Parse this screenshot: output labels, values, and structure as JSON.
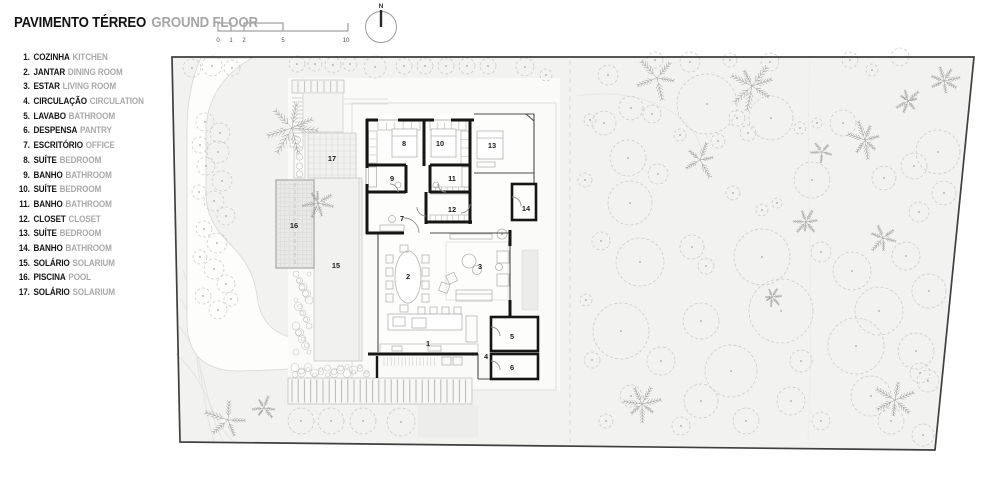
{
  "header": {
    "title_pt": "PAVIMENTO TÉRREO",
    "title_en": "GROUND FLOOR"
  },
  "scalebar": {
    "ticks": [
      "0",
      "1",
      "2",
      "5",
      "10"
    ]
  },
  "north": {
    "label": "N"
  },
  "legend": {
    "items": [
      {
        "num": "1.",
        "pt": "COZINHA",
        "en": "KITCHEN"
      },
      {
        "num": "2.",
        "pt": "JANTAR",
        "en": "DINING ROOM"
      },
      {
        "num": "3.",
        "pt": "ESTAR",
        "en": "LIVING ROOM"
      },
      {
        "num": "4.",
        "pt": "CIRCULAÇÃO",
        "en": "CIRCULATION"
      },
      {
        "num": "5.",
        "pt": "LAVABO",
        "en": "BATHROOM"
      },
      {
        "num": "6.",
        "pt": "DESPENSA",
        "en": "PANTRY"
      },
      {
        "num": "7.",
        "pt": "ESCRITÓRIO",
        "en": "OFFICE"
      },
      {
        "num": "8.",
        "pt": "SUÍTE",
        "en": "BEDROOM"
      },
      {
        "num": "9.",
        "pt": "BANHO",
        "en": "BATHROOM"
      },
      {
        "num": "10.",
        "pt": "SUÍTE",
        "en": "BEDROOM"
      },
      {
        "num": "11.",
        "pt": "BANHO",
        "en": "BATHROOM"
      },
      {
        "num": "12.",
        "pt": "CLOSET",
        "en": "CLOSET"
      },
      {
        "num": "13.",
        "pt": "SUÍTE",
        "en": "BEDROOM"
      },
      {
        "num": "14.",
        "pt": "BANHO",
        "en": "BATHROOM"
      },
      {
        "num": "15.",
        "pt": "SOLÁRIO",
        "en": "SOLARIUM"
      },
      {
        "num": "16.",
        "pt": "PISCINA",
        "en": "POOL"
      },
      {
        "num": "17.",
        "pt": "SOLÁRIO",
        "en": "SOLARIUM"
      }
    ]
  },
  "plan": {
    "rooms": [
      {
        "num": "1",
        "x": 428,
        "y": 346
      },
      {
        "num": "2",
        "x": 408,
        "y": 279
      },
      {
        "num": "3",
        "x": 480,
        "y": 269
      },
      {
        "num": "4",
        "x": 486,
        "y": 359
      },
      {
        "num": "5",
        "x": 512,
        "y": 339
      },
      {
        "num": "6",
        "x": 512,
        "y": 370
      },
      {
        "num": "7",
        "x": 402,
        "y": 221
      },
      {
        "num": "8",
        "x": 404,
        "y": 146
      },
      {
        "num": "9",
        "x": 392,
        "y": 181
      },
      {
        "num": "10",
        "x": 440,
        "y": 146
      },
      {
        "num": "11",
        "x": 452,
        "y": 181
      },
      {
        "num": "12",
        "x": 452,
        "y": 212
      },
      {
        "num": "13",
        "x": 492,
        "y": 148
      },
      {
        "num": "14",
        "x": 526,
        "y": 211
      },
      {
        "num": "15",
        "x": 336,
        "y": 268
      },
      {
        "num": "16",
        "x": 294,
        "y": 228
      },
      {
        "num": "17",
        "x": 332,
        "y": 161
      }
    ],
    "vegetation": {
      "canopies": [
        [
          608,
          75,
          10
        ],
        [
          631,
          108,
          12
        ],
        [
          652,
          114,
          9
        ],
        [
          604,
          123,
          12
        ],
        [
          707,
          104,
          30
        ],
        [
          771,
          118,
          22
        ],
        [
          737,
          118,
          8
        ],
        [
          800,
          128,
          6
        ],
        [
          817,
          123,
          5
        ],
        [
          843,
          123,
          13
        ],
        [
          872,
          70,
          6
        ],
        [
          900,
          57,
          9
        ],
        [
          938,
          152,
          22
        ],
        [
          914,
          166,
          13
        ],
        [
          628,
          158,
          18
        ],
        [
          658,
          174,
          10
        ],
        [
          630,
          203,
          22
        ],
        [
          733,
          193,
          7
        ],
        [
          812,
          180,
          18
        ],
        [
          884,
          178,
          12
        ],
        [
          944,
          193,
          12
        ],
        [
          919,
          212,
          10
        ],
        [
          718,
          141,
          7
        ],
        [
          748,
          133,
          8
        ],
        [
          680,
          135,
          6
        ],
        [
          762,
          210,
          6
        ],
        [
          777,
          203,
          5
        ],
        [
          640,
          262,
          24
        ],
        [
          692,
          247,
          12
        ],
        [
          706,
          266,
          8
        ],
        [
          762,
          257,
          28
        ],
        [
          821,
          252,
          10
        ],
        [
          852,
          271,
          19
        ],
        [
          906,
          256,
          14
        ],
        [
          929,
          291,
          17
        ],
        [
          879,
          311,
          24
        ],
        [
          781,
          311,
          32
        ],
        [
          701,
          321,
          18
        ],
        [
          621,
          331,
          28
        ],
        [
          661,
          361,
          14
        ],
        [
          731,
          371,
          26
        ],
        [
          801,
          361,
          11
        ],
        [
          856,
          346,
          28
        ],
        [
          916,
          351,
          18
        ],
        [
          928,
          381,
          11
        ],
        [
          871,
          396,
          20
        ],
        [
          791,
          401,
          14
        ],
        [
          701,
          401,
          17
        ],
        [
          631,
          396,
          11
        ],
        [
          606,
          421,
          7
        ],
        [
          681,
          426,
          9
        ],
        [
          746,
          421,
          13
        ],
        [
          821,
          421,
          9
        ],
        [
          891,
          421,
          13
        ],
        [
          920,
          373,
          10
        ],
        [
          923,
          435,
          11
        ],
        [
          601,
          241,
          9
        ],
        [
          586,
          300,
          6
        ],
        [
          592,
          360,
          8
        ],
        [
          585,
          180,
          7
        ],
        [
          590,
          120,
          6
        ],
        [
          655,
          60,
          8
        ],
        [
          690,
          62,
          10
        ],
        [
          730,
          60,
          7
        ],
        [
          770,
          62,
          9
        ],
        [
          850,
          60,
          8
        ],
        [
          192,
          68,
          9
        ],
        [
          212,
          66,
          10
        ],
        [
          232,
          68,
          8
        ],
        [
          297,
          64,
          8
        ],
        [
          315,
          64,
          7
        ],
        [
          333,
          65,
          8
        ],
        [
          350,
          64,
          7
        ],
        [
          375,
          67,
          11
        ],
        [
          404,
          66,
          8
        ],
        [
          425,
          66,
          8
        ],
        [
          446,
          66,
          8
        ],
        [
          467,
          66,
          8
        ],
        [
          488,
          66,
          8
        ],
        [
          525,
          67,
          9
        ],
        [
          546,
          75,
          6
        ]
      ],
      "cluster": [
        [
          205,
          122,
          9
        ],
        [
          220,
          133,
          10
        ],
        [
          200,
          145,
          8
        ],
        [
          218,
          152,
          11
        ],
        [
          206,
          166,
          9
        ],
        [
          222,
          181,
          10
        ],
        [
          199,
          192,
          7
        ],
        [
          214,
          201,
          10
        ],
        [
          226,
          216,
          9
        ],
        [
          204,
          229,
          8
        ],
        [
          217,
          243,
          10
        ],
        [
          200,
          257,
          7
        ],
        [
          214,
          269,
          10
        ],
        [
          226,
          284,
          9
        ],
        [
          203,
          296,
          8
        ],
        [
          218,
          310,
          9
        ],
        [
          231,
          299,
          7
        ]
      ],
      "shrubs": [
        [
          301,
          421,
          13
        ],
        [
          331,
          421,
          13
        ],
        [
          363,
          421,
          13
        ],
        [
          401,
          422,
          14
        ]
      ],
      "pines": [
        [
          292,
          128,
          30
        ],
        [
          318,
          203,
          16
        ],
        [
          228,
          420,
          24
        ],
        [
          264,
          408,
          13
        ],
        [
          657,
          78,
          26
        ],
        [
          752,
          86,
          24
        ],
        [
          700,
          160,
          20
        ],
        [
          865,
          140,
          20
        ],
        [
          908,
          101,
          14
        ],
        [
          944,
          81,
          18
        ],
        [
          806,
          222,
          14
        ],
        [
          883,
          238,
          18
        ],
        [
          642,
          404,
          20
        ],
        [
          895,
          400,
          24
        ],
        [
          822,
          152,
          12
        ],
        [
          772,
          297,
          10
        ]
      ]
    },
    "colors": {
      "site_fill": "#f2f2f1",
      "boundary": "#3f3f3f",
      "wall": "#151515",
      "canopy": "#c7c7c5",
      "cluster": "#c9c9c7",
      "shrub": "#c4c4c2",
      "pine": "#9b9b99",
      "furniture": "#b3b3b1",
      "deck": "#f1f1ef",
      "pool": "#e9e9e7"
    }
  }
}
